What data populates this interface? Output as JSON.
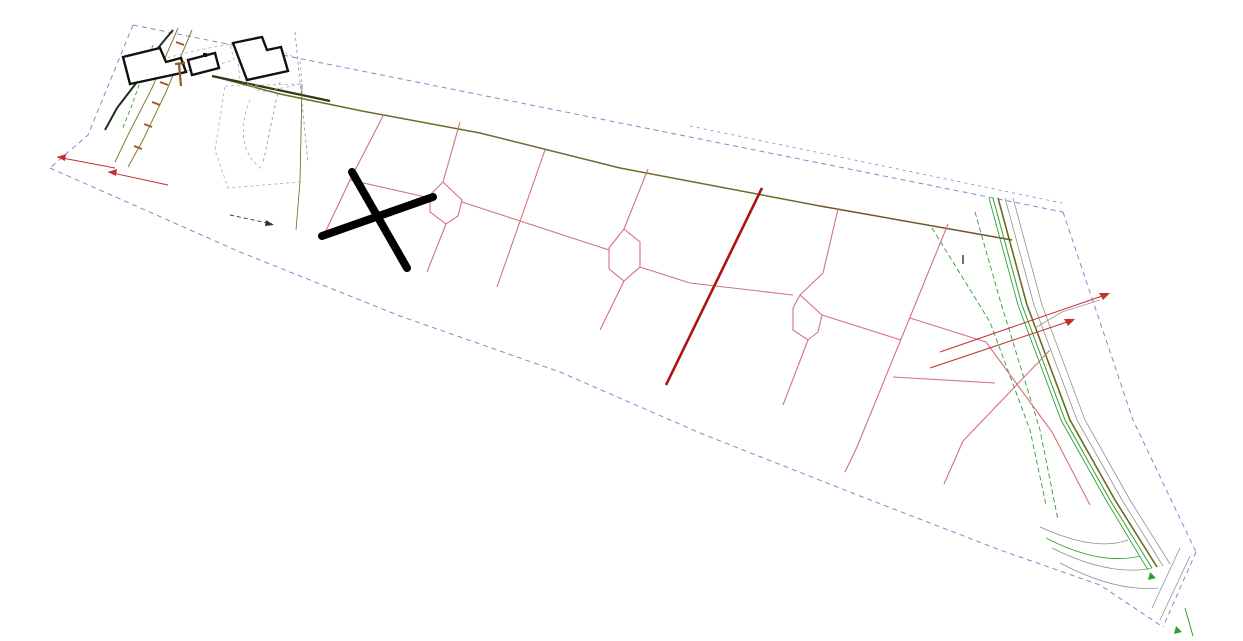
{
  "watermark": {
    "text": "MARTEX CONSULTING"
  },
  "annotations": {
    "reservation": {
      "label": "Rezerwacja",
      "x": 400,
      "y": 155
    },
    "sold": {
      "label": "SPRZEDANA",
      "x": 368,
      "y": 220
    }
  },
  "street": {
    "label": "Kolejowa",
    "x": 152,
    "y": 180,
    "angle": 24
  },
  "plots": [
    {
      "id": "1",
      "label": "Nr 1",
      "x": 160,
      "y": 118
    },
    {
      "id": "2",
      "label": "Nr 2",
      "x": 275,
      "y": 176
    },
    {
      "id": "3",
      "label": "Nr 3",
      "x": 395,
      "y": 131
    },
    {
      "id": "4",
      "label": "Nr 4",
      "x": 382,
      "y": 194
    },
    {
      "id": "5",
      "label": "5",
      "x": 444,
      "y": 193
    },
    {
      "id": "6",
      "label": "Nr 6",
      "x": 495,
      "y": 156
    },
    {
      "id": "7",
      "label": "Nr.7",
      "x": 476,
      "y": 235
    },
    {
      "id": "8",
      "label": "Nr 8",
      "x": 592,
      "y": 175
    },
    {
      "id": "9",
      "label": "Nr 9",
      "x": 553,
      "y": 252
    },
    {
      "id": "10",
      "label": "10",
      "x": 635,
      "y": 247
    },
    {
      "id": "11",
      "label": "Nr 11",
      "x": 686,
      "y": 193
    },
    {
      "id": "12",
      "label": "Nr 12",
      "x": 666,
      "y": 284
    },
    {
      "id": "13",
      "label": "Nr 13",
      "x": 788,
      "y": 221
    },
    {
      "id": "14",
      "label": "Nr 14",
      "x": 733,
      "y": 309
    },
    {
      "id": "15",
      "label": "15",
      "x": 815,
      "y": 299
    },
    {
      "id": "16",
      "label": "Nr 16",
      "x": 869,
      "y": 238
    },
    {
      "id": "17",
      "label": "Nr 17",
      "x": 843,
      "y": 341
    },
    {
      "id": "18",
      "label": "Nr 18",
      "x": 958,
      "y": 256
    },
    {
      "id": "19",
      "label": "Nr 19",
      "x": 929,
      "y": 335
    },
    {
      "id": "20",
      "label": "Nr 20",
      "x": 901,
      "y": 405
    },
    {
      "id": "21",
      "label": "21",
      "x": 1017,
      "y": 371
    },
    {
      "id": "22",
      "label": "Nr 22",
      "x": 1043,
      "y": 416
    }
  ],
  "parcel_markers": [
    [
      187,
      92
    ],
    [
      303,
      148
    ],
    [
      419,
      150
    ],
    [
      393,
      222
    ],
    [
      444,
      205
    ],
    [
      511,
      172
    ],
    [
      474,
      245
    ],
    [
      598,
      188
    ],
    [
      566,
      262
    ],
    [
      621,
      250
    ],
    [
      697,
      218
    ],
    [
      659,
      306
    ],
    [
      776,
      238
    ],
    [
      740,
      345
    ],
    [
      806,
      308
    ],
    [
      878,
      257
    ],
    [
      832,
      352
    ],
    [
      987,
      273
    ],
    [
      945,
      350
    ],
    [
      921,
      430
    ],
    [
      989,
      424
    ],
    [
      1041,
      436
    ],
    [
      876,
      354
    ]
  ],
  "grid_crosses": [
    [
      58,
      103
    ],
    [
      209,
      104
    ],
    [
      359,
      102
    ],
    [
      510,
      102
    ],
    [
      661,
      101
    ],
    [
      812,
      101
    ],
    [
      209,
      256
    ],
    [
      359,
      255
    ],
    [
      511,
      255
    ],
    [
      665,
      255
    ],
    [
      814,
      255
    ],
    [
      1116,
      256
    ],
    [
      511,
      408
    ],
    [
      663,
      407
    ],
    [
      815,
      407
    ],
    [
      966,
      406
    ],
    [
      1117,
      406
    ],
    [
      966,
      557
    ],
    [
      1117,
      556
    ]
  ],
  "micro_labels": [
    {
      "text": "49",
      "x": 145,
      "y": 36,
      "r": -72
    },
    {
      "text": "58",
      "x": 170,
      "y": 89,
      "r": -72
    },
    {
      "text": "35",
      "x": 116,
      "y": 97,
      "r": -72
    },
    {
      "text": "2",
      "x": 263,
      "y": 53,
      "r": -15
    },
    {
      "text": "84",
      "x": 260,
      "y": 66,
      "r": -15
    },
    {
      "text": "=",
      "x": 228,
      "y": 70,
      "r": 0
    },
    {
      "text": "120,98",
      "x": 1058,
      "y": 278,
      "r": -75
    },
    {
      "text": "0595#50",
      "x": 1130,
      "y": 406,
      "r": -15
    },
    {
      "text": "L596/300",
      "x": 1110,
      "y": 434,
      "r": -72
    },
    {
      "text": "18/08",
      "x": 1131,
      "y": 452,
      "r": -72
    }
  ],
  "green_trees": [
    [
      150,
      47
    ],
    [
      218,
      48
    ],
    [
      295,
      63
    ],
    [
      302,
      75
    ],
    [
      288,
      93
    ],
    [
      207,
      142
    ],
    [
      130,
      72
    ]
  ],
  "green_ticks": [
    [
      145,
      202
    ],
    [
      242,
      241
    ],
    [
      457,
      318
    ],
    [
      787,
      463
    ],
    [
      1038,
      586
    ],
    [
      765,
      173
    ],
    [
      662,
      280
    ],
    [
      713,
      412
    ]
  ],
  "blue_ticks": [
    [
      82,
      172
    ],
    [
      128,
      193
    ],
    [
      232,
      237
    ],
    [
      253,
      260
    ],
    [
      302,
      275
    ],
    [
      575,
      330
    ],
    [
      830,
      480
    ]
  ],
  "pink_dashes_x": [
    150,
    240,
    330,
    430,
    520,
    610,
    700,
    790,
    870,
    950,
    1030
  ],
  "colors": {
    "parcel": "#d4717f",
    "parcel_dark": "#b01212",
    "road_olive": "#6b6b23",
    "gray": "#909090",
    "green": "#2fa12f",
    "blue_dash": "#8787cf",
    "red_arrow": "#c23030",
    "marker_red": "#c22222",
    "watermark_fill": "#d8d8d8",
    "watermark_edge": "#a8a8a8",
    "cross_black": "#000000"
  }
}
